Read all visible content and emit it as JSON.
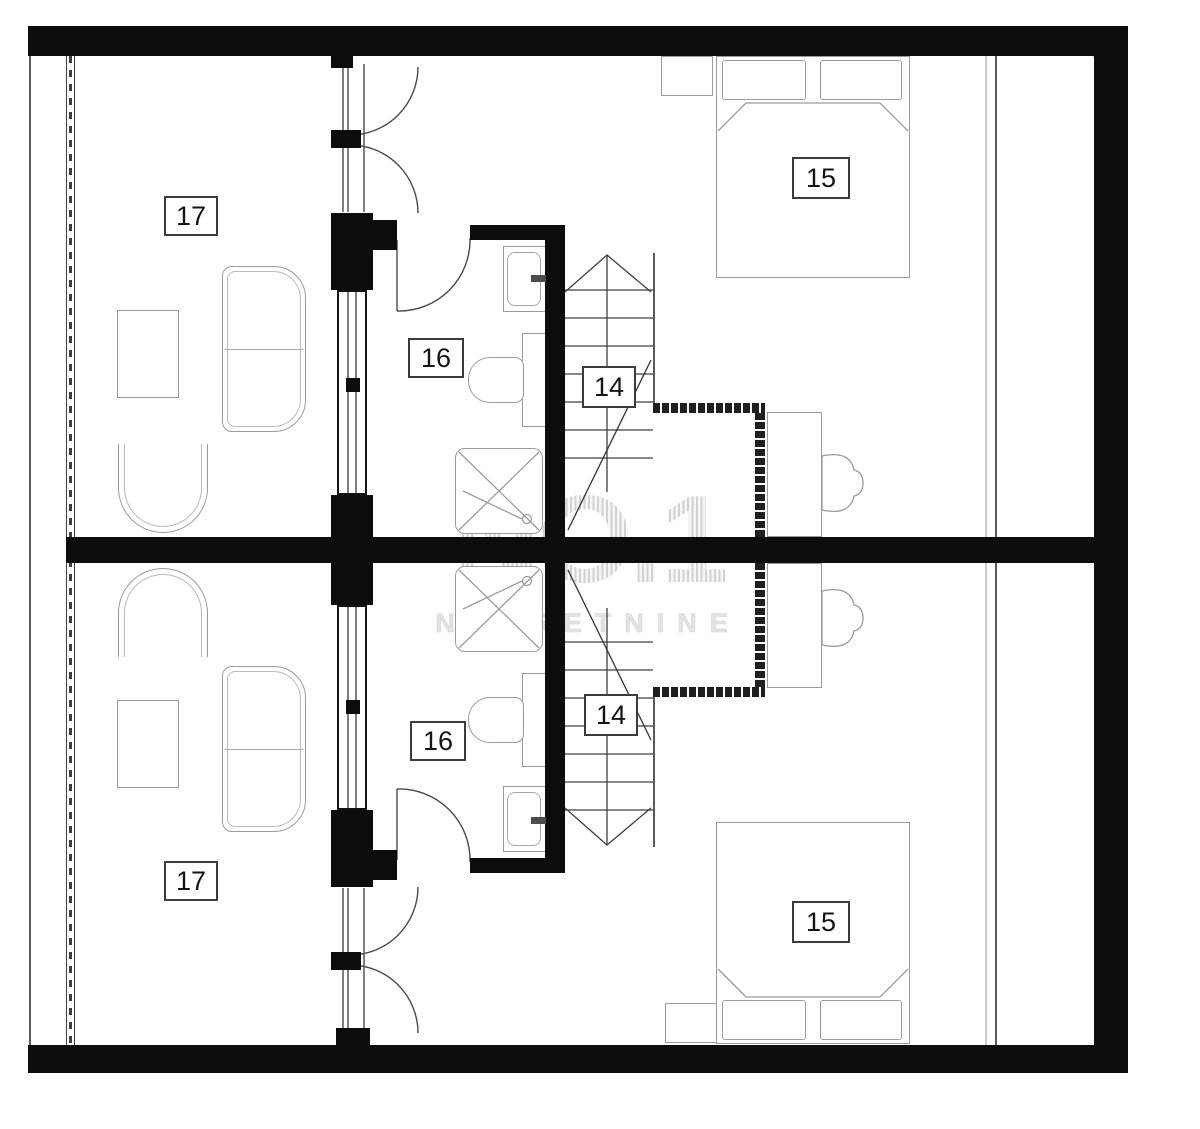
{
  "watermark": {
    "brand": "NO.1",
    "subtitle": "NEKRETNINE"
  },
  "labels": {
    "living_upper": "17",
    "living_lower": "17",
    "bath_upper": "16",
    "bath_lower": "16",
    "stair_upper": "14",
    "stair_lower": "14",
    "bedroom_upper": "15",
    "bedroom_lower": "15"
  },
  "colors": {
    "wall": "#0d0d0d",
    "furniture_line": "#9b9b9b",
    "watermark": "#d9d9d9"
  }
}
